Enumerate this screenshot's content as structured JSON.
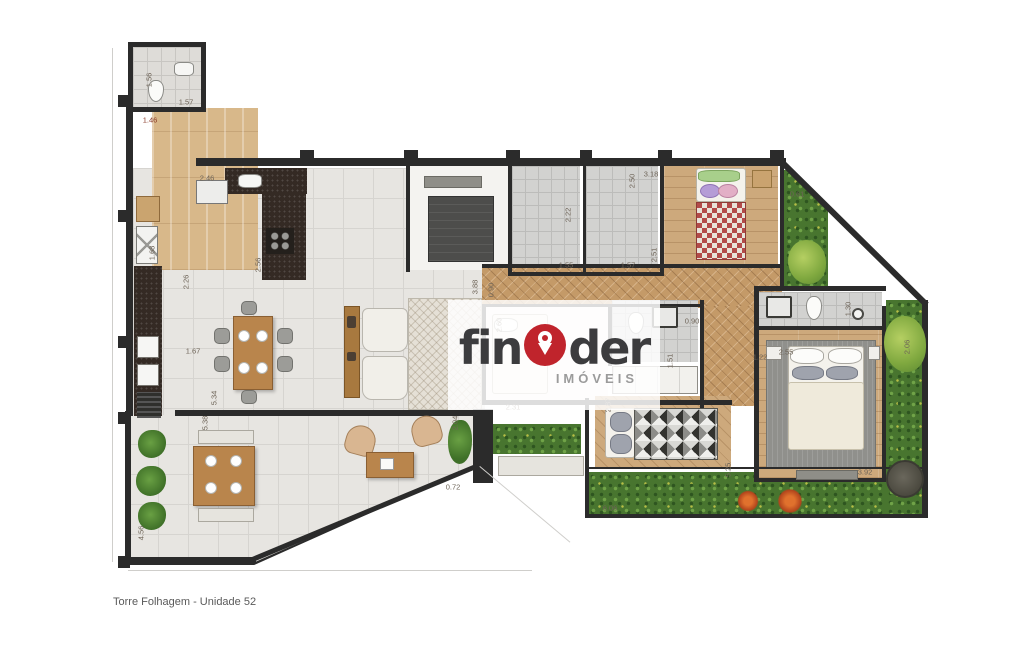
{
  "meta": {
    "caption": "Torre Folhagem - Unidade 52"
  },
  "watermark": {
    "brand_prefix": "fin",
    "brand_suffix": "der",
    "subtitle": "IMÓVEIS",
    "accent": "#c0242c",
    "text_color": "#3c3c3e"
  },
  "plan": {
    "wall_color": "#2b2b2b",
    "rooms": [
      {
        "n": "terrace-outline",
        "c": "wall-poly",
        "x": 125,
        "y": 411,
        "w": 363,
        "h": 154
      },
      {
        "n": "terrace",
        "c": "tile terrace-clip",
        "x": 128,
        "y": 414,
        "w": 357,
        "h": 148
      },
      {
        "n": "kitchen-living-floor",
        "c": "tile",
        "x": 133,
        "y": 168,
        "w": 352,
        "h": 247
      },
      {
        "n": "service-corridor",
        "c": "wood-v",
        "x": 152,
        "y": 108,
        "w": 106,
        "h": 162
      },
      {
        "n": "entry-bath",
        "c": "tile-sm",
        "x": 133,
        "y": 47,
        "w": 68,
        "h": 60
      },
      {
        "n": "central-room",
        "c": "white-room",
        "x": 408,
        "y": 166,
        "w": 100,
        "h": 104
      },
      {
        "n": "bath-1",
        "c": "gray-tile",
        "x": 512,
        "y": 166,
        "w": 68,
        "h": 108
      },
      {
        "n": "bath-2",
        "c": "gray-tile",
        "x": 586,
        "y": 166,
        "w": 72,
        "h": 108
      },
      {
        "n": "bedroom-1",
        "c": "wood-h",
        "x": 664,
        "y": 166,
        "w": 114,
        "h": 110
      },
      {
        "n": "garden-top",
        "c": "garden clip-tr",
        "x": 784,
        "y": 170,
        "w": 44,
        "h": 120
      },
      {
        "n": "hall-herringbone",
        "c": "herringbone",
        "x": 482,
        "y": 268,
        "w": 300,
        "h": 40
      },
      {
        "n": "hall-herringbone-2",
        "c": "herringbone",
        "x": 700,
        "y": 306,
        "w": 54,
        "h": 100
      },
      {
        "n": "garden-bottom",
        "c": "garden",
        "x": 588,
        "y": 472,
        "w": 338,
        "h": 44
      },
      {
        "n": "garden-right",
        "c": "garden",
        "x": 886,
        "y": 300,
        "w": 38,
        "h": 216
      },
      {
        "n": "center-bedroom",
        "c": "white-room",
        "x": 486,
        "y": 306,
        "w": 122,
        "h": 94
      },
      {
        "n": "center-bath",
        "c": "gray-tile",
        "x": 612,
        "y": 300,
        "w": 86,
        "h": 62
      },
      {
        "n": "single-bedroom",
        "c": "wood-diag",
        "x": 595,
        "y": 396,
        "w": 136,
        "h": 72
      },
      {
        "n": "master-bath",
        "c": "gray-tile",
        "x": 758,
        "y": 292,
        "w": 124,
        "h": 36
      },
      {
        "n": "master-bedroom",
        "c": "wood-h",
        "x": 758,
        "y": 330,
        "w": 124,
        "h": 148
      },
      {
        "n": "master-rug",
        "c": "rug-gray",
        "x": 766,
        "y": 340,
        "w": 110,
        "h": 128
      },
      {
        "n": "living-rug",
        "c": "rug-hatch",
        "x": 408,
        "y": 298,
        "w": 74,
        "h": 112
      },
      {
        "n": "laundry-counter",
        "c": "dark-counter",
        "x": 134,
        "y": 266,
        "w": 28,
        "h": 150
      },
      {
        "n": "kitchen-counter-top",
        "c": "dark-counter",
        "x": 225,
        "y": 168,
        "w": 82,
        "h": 26
      },
      {
        "n": "kitchen-counter-side",
        "c": "dark-counter",
        "x": 262,
        "y": 194,
        "w": 44,
        "h": 86
      },
      {
        "n": "planter-strip",
        "c": "garden",
        "x": 493,
        "y": 424,
        "w": 88,
        "h": 30
      }
    ],
    "walls": [
      {
        "x": 126,
        "y": 96,
        "w": 7,
        "h": 320
      },
      {
        "x": 126,
        "y": 414,
        "w": 5,
        "h": 148
      },
      {
        "x": 128,
        "y": 557,
        "w": 128,
        "h": 5
      },
      {
        "x": 252,
        "y": 557,
        "w": 248,
        "h": 5,
        "r": -22.6
      },
      {
        "x": 175,
        "y": 410,
        "w": 312,
        "h": 6
      },
      {
        "x": 196,
        "y": 158,
        "w": 590,
        "h": 8
      },
      {
        "x": 128,
        "y": 42,
        "w": 78,
        "h": 5
      },
      {
        "x": 128,
        "y": 42,
        "w": 5,
        "h": 70
      },
      {
        "x": 201,
        "y": 42,
        "w": 5,
        "h": 70
      },
      {
        "x": 128,
        "y": 107,
        "w": 78,
        "h": 5
      },
      {
        "x": 406,
        "y": 162,
        "w": 4,
        "h": 110
      },
      {
        "x": 508,
        "y": 162,
        "w": 4,
        "h": 114
      },
      {
        "x": 583,
        "y": 162,
        "w": 3,
        "h": 114
      },
      {
        "x": 660,
        "y": 162,
        "w": 4,
        "h": 114
      },
      {
        "x": 780,
        "y": 162,
        "w": 4,
        "h": 128
      },
      {
        "x": 510,
        "y": 272,
        "w": 152,
        "h": 4
      },
      {
        "x": 482,
        "y": 264,
        "w": 302,
        "h": 4
      },
      {
        "x": 482,
        "y": 304,
        "w": 222,
        "h": 3
      },
      {
        "x": 482,
        "y": 304,
        "w": 4,
        "h": 100
      },
      {
        "x": 482,
        "y": 400,
        "w": 250,
        "h": 5
      },
      {
        "x": 608,
        "y": 306,
        "w": 4,
        "h": 60
      },
      {
        "x": 700,
        "y": 300,
        "w": 4,
        "h": 108
      },
      {
        "x": 754,
        "y": 286,
        "w": 132,
        "h": 5
      },
      {
        "x": 754,
        "y": 286,
        "w": 5,
        "h": 194
      },
      {
        "x": 756,
        "y": 326,
        "w": 128,
        "h": 4
      },
      {
        "x": 882,
        "y": 306,
        "w": 4,
        "h": 174
      },
      {
        "x": 922,
        "y": 300,
        "w": 6,
        "h": 218
      },
      {
        "x": 782,
        "y": 158,
        "w": 206,
        "h": 6,
        "r": 44.6
      },
      {
        "x": 585,
        "y": 514,
        "w": 343,
        "h": 4
      },
      {
        "x": 585,
        "y": 398,
        "w": 4,
        "h": 118
      },
      {
        "x": 588,
        "y": 467,
        "w": 340,
        "h": 2
      },
      {
        "x": 754,
        "y": 478,
        "w": 132,
        "h": 4
      },
      {
        "x": 473,
        "y": 409,
        "w": 20,
        "h": 74
      },
      {
        "x": 300,
        "y": 150,
        "w": 14,
        "h": 10
      },
      {
        "x": 404,
        "y": 150,
        "w": 14,
        "h": 10
      },
      {
        "x": 506,
        "y": 150,
        "w": 14,
        "h": 10
      },
      {
        "x": 580,
        "y": 150,
        "w": 12,
        "h": 10
      },
      {
        "x": 658,
        "y": 150,
        "w": 14,
        "h": 10
      },
      {
        "x": 770,
        "y": 150,
        "w": 14,
        "h": 10
      },
      {
        "x": 118,
        "y": 95,
        "w": 12,
        "h": 12
      },
      {
        "x": 118,
        "y": 210,
        "w": 12,
        "h": 12
      },
      {
        "x": 118,
        "y": 336,
        "w": 12,
        "h": 12
      },
      {
        "x": 118,
        "y": 412,
        "w": 12,
        "h": 12
      },
      {
        "x": 118,
        "y": 556,
        "w": 12,
        "h": 12
      },
      {
        "x": 112,
        "y": 48,
        "w": 1,
        "h": 514,
        "bg": "#cfcecb"
      },
      {
        "x": 128,
        "y": 570,
        "w": 404,
        "h": 1,
        "bg": "#cfcecb"
      },
      {
        "x": 480,
        "y": 466,
        "w": 118,
        "h": 1,
        "r": 40,
        "bg": "#cfcecb"
      }
    ],
    "furniture": [
      {
        "k": "toilet",
        "x": 148,
        "y": 80,
        "w": 16,
        "h": 22
      },
      {
        "k": "sink",
        "x": 174,
        "y": 62,
        "w": 20,
        "h": 14
      },
      {
        "k": "cab",
        "x": 196,
        "y": 180,
        "w": 32,
        "h": 24
      },
      {
        "k": "sink",
        "x": 238,
        "y": 174,
        "w": 24,
        "h": 14
      },
      {
        "k": "cooktop",
        "x": 266,
        "y": 228,
        "w": 28,
        "h": 26
      },
      {
        "k": "cab-wood",
        "x": 136,
        "y": 196,
        "w": 24,
        "h": 26
      },
      {
        "k": "xcab",
        "x": 136,
        "y": 226,
        "w": 22,
        "h": 38
      },
      {
        "k": "washer",
        "x": 137,
        "y": 336,
        "w": 22,
        "h": 22
      },
      {
        "k": "washer",
        "x": 137,
        "y": 364,
        "w": 22,
        "h": 22
      },
      {
        "k": "grill",
        "x": 137,
        "y": 392,
        "w": 24,
        "h": 26
      },
      {
        "k": "bench-dark",
        "x": 424,
        "y": 176,
        "w": 58,
        "h": 12
      },
      {
        "k": "dark-box",
        "x": 428,
        "y": 196,
        "w": 66,
        "h": 66
      },
      {
        "k": "table-wood",
        "x": 233,
        "y": 316,
        "w": 40,
        "h": 74
      },
      {
        "k": "chair",
        "x": 214,
        "y": 328,
        "w": 16,
        "h": 16
      },
      {
        "k": "chair",
        "x": 214,
        "y": 356,
        "w": 16,
        "h": 16
      },
      {
        "k": "chair",
        "x": 277,
        "y": 328,
        "w": 16,
        "h": 16
      },
      {
        "k": "chair",
        "x": 277,
        "y": 356,
        "w": 16,
        "h": 16
      },
      {
        "k": "chair",
        "x": 241,
        "y": 301,
        "w": 16,
        "h": 14
      },
      {
        "k": "chair",
        "x": 241,
        "y": 390,
        "w": 16,
        "h": 14
      },
      {
        "k": "plate",
        "x": 238,
        "y": 330,
        "w": 12,
        "h": 12
      },
      {
        "k": "plate",
        "x": 256,
        "y": 330,
        "w": 12,
        "h": 12
      },
      {
        "k": "plate",
        "x": 238,
        "y": 362,
        "w": 12,
        "h": 12
      },
      {
        "k": "plate",
        "x": 256,
        "y": 362,
        "w": 12,
        "h": 12
      },
      {
        "k": "console",
        "x": 344,
        "y": 306,
        "w": 16,
        "h": 92
      },
      {
        "k": "deco",
        "x": 347,
        "y": 316,
        "w": 9,
        "h": 12
      },
      {
        "k": "deco",
        "x": 347,
        "y": 352,
        "w": 9,
        "h": 9
      },
      {
        "k": "sofa",
        "x": 362,
        "y": 308,
        "w": 46,
        "h": 44
      },
      {
        "k": "sofa",
        "x": 362,
        "y": 356,
        "w": 46,
        "h": 44
      },
      {
        "k": "armchair",
        "x": 350,
        "y": 422,
        "w": 30,
        "h": 30,
        "r": 15
      },
      {
        "k": "armchair",
        "x": 408,
        "y": 420,
        "w": 30,
        "h": 30,
        "r": -15
      },
      {
        "k": "table-wood",
        "x": 366,
        "y": 452,
        "w": 48,
        "h": 26
      },
      {
        "k": "deco-white",
        "x": 380,
        "y": 458,
        "w": 14,
        "h": 12
      },
      {
        "k": "plant",
        "x": 448,
        "y": 420,
        "w": 24,
        "h": 44
      },
      {
        "k": "bench",
        "x": 198,
        "y": 430,
        "w": 56,
        "h": 14
      },
      {
        "k": "table-wood",
        "x": 193,
        "y": 446,
        "w": 62,
        "h": 60
      },
      {
        "k": "bench",
        "x": 198,
        "y": 508,
        "w": 56,
        "h": 14
      },
      {
        "k": "plate",
        "x": 205,
        "y": 455,
        "w": 12,
        "h": 12
      },
      {
        "k": "plate",
        "x": 230,
        "y": 455,
        "w": 12,
        "h": 12
      },
      {
        "k": "plate",
        "x": 205,
        "y": 482,
        "w": 12,
        "h": 12
      },
      {
        "k": "plate",
        "x": 230,
        "y": 482,
        "w": 12,
        "h": 12
      },
      {
        "k": "plant",
        "x": 138,
        "y": 430,
        "w": 28,
        "h": 28
      },
      {
        "k": "plant",
        "x": 136,
        "y": 466,
        "w": 30,
        "h": 30
      },
      {
        "k": "plant",
        "x": 138,
        "y": 502,
        "w": 28,
        "h": 28
      },
      {
        "k": "sheet",
        "x": 696,
        "y": 168,
        "w": 50,
        "h": 34
      },
      {
        "k": "pillow-green",
        "x": 698,
        "y": 170,
        "w": 42,
        "h": 12
      },
      {
        "k": "pillow-purple",
        "x": 700,
        "y": 184,
        "w": 20,
        "h": 14
      },
      {
        "k": "pillow-pink",
        "x": 718,
        "y": 184,
        "w": 20,
        "h": 14
      },
      {
        "k": "blanket-red",
        "x": 696,
        "y": 202,
        "w": 50,
        "h": 58
      },
      {
        "k": "side-table",
        "x": 752,
        "y": 170,
        "w": 20,
        "h": 18
      },
      {
        "k": "sheet",
        "x": 492,
        "y": 314,
        "w": 56,
        "h": 80
      },
      {
        "k": "pillow",
        "x": 494,
        "y": 318,
        "w": 24,
        "h": 14
      },
      {
        "k": "toilet",
        "x": 628,
        "y": 312,
        "w": 16,
        "h": 22
      },
      {
        "k": "sink-dark",
        "x": 652,
        "y": 306,
        "w": 26,
        "h": 22
      },
      {
        "k": "wardrobe",
        "x": 612,
        "y": 366,
        "w": 86,
        "h": 28
      },
      {
        "k": "bench",
        "x": 498,
        "y": 456,
        "w": 86,
        "h": 20
      },
      {
        "k": "sink-dark",
        "x": 766,
        "y": 296,
        "w": 26,
        "h": 22
      },
      {
        "k": "toilet",
        "x": 806,
        "y": 296,
        "w": 16,
        "h": 24
      },
      {
        "k": "lamp",
        "x": 852,
        "y": 308,
        "w": 12,
        "h": 12
      },
      {
        "k": "sheet",
        "x": 788,
        "y": 346,
        "w": 76,
        "h": 40
      },
      {
        "k": "pillow",
        "x": 790,
        "y": 348,
        "w": 34,
        "h": 16
      },
      {
        "k": "pillow",
        "x": 828,
        "y": 348,
        "w": 34,
        "h": 16
      },
      {
        "k": "pillow-gray",
        "x": 792,
        "y": 366,
        "w": 32,
        "h": 14
      },
      {
        "k": "pillow-gray",
        "x": 826,
        "y": 366,
        "w": 32,
        "h": 14
      },
      {
        "k": "duvet",
        "x": 788,
        "y": 382,
        "w": 76,
        "h": 68
      },
      {
        "k": "bench-dark",
        "x": 796,
        "y": 470,
        "w": 62,
        "h": 10
      },
      {
        "k": "nightstand",
        "x": 766,
        "y": 346,
        "w": 16,
        "h": 14
      },
      {
        "k": "nightstand",
        "x": 868,
        "y": 346,
        "w": 12,
        "h": 14
      },
      {
        "k": "sheet",
        "x": 605,
        "y": 408,
        "w": 30,
        "h": 50
      },
      {
        "k": "pillow-gray",
        "x": 610,
        "y": 412,
        "w": 22,
        "h": 20
      },
      {
        "k": "pillow-gray",
        "x": 610,
        "y": 434,
        "w": 22,
        "h": 20
      },
      {
        "k": "blanket-tri",
        "x": 634,
        "y": 408,
        "w": 84,
        "h": 52
      },
      {
        "k": "dark-circle",
        "x": 886,
        "y": 460,
        "w": 38,
        "h": 38
      },
      {
        "k": "bush",
        "x": 788,
        "y": 240,
        "w": 38,
        "h": 44
      },
      {
        "k": "bush",
        "x": 884,
        "y": 316,
        "w": 42,
        "h": 56
      },
      {
        "k": "flower",
        "x": 735,
        "y": 490,
        "w": 26,
        "h": 22
      },
      {
        "k": "flower",
        "x": 775,
        "y": 488,
        "w": 30,
        "h": 26
      }
    ],
    "labels": [
      {
        "t": "1.56",
        "x": 149,
        "y": 80,
        "r": -90
      },
      {
        "t": "1.57",
        "x": 186,
        "y": 102
      },
      {
        "t": "1.46",
        "x": 150,
        "y": 120,
        "bg2": "none",
        "col": "#8a3a28"
      },
      {
        "t": "2.46",
        "x": 207,
        "y": 178
      },
      {
        "t": "2.56",
        "x": 258,
        "y": 265,
        "r": -90
      },
      {
        "t": "1.68",
        "x": 152,
        "y": 253,
        "r": -90
      },
      {
        "t": "2.26",
        "x": 186,
        "y": 282,
        "r": -90
      },
      {
        "t": "1.67",
        "x": 193,
        "y": 351
      },
      {
        "t": "5.34",
        "x": 214,
        "y": 398,
        "r": -90
      },
      {
        "t": "5.38",
        "x": 205,
        "y": 423,
        "r": -90
      },
      {
        "t": "4.56",
        "x": 141,
        "y": 533,
        "r": -90
      },
      {
        "t": "2.22",
        "x": 568,
        "y": 215,
        "r": -90
      },
      {
        "t": "1.55",
        "x": 566,
        "y": 265
      },
      {
        "t": "2.50",
        "x": 632,
        "y": 181,
        "r": -90
      },
      {
        "t": "1.57",
        "x": 628,
        "y": 265
      },
      {
        "t": "2.51",
        "x": 654,
        "y": 255,
        "r": -90
      },
      {
        "t": "3.18",
        "x": 651,
        "y": 174
      },
      {
        "t": "0.61",
        "x": 797,
        "y": 194
      },
      {
        "t": "3.88",
        "x": 475,
        "y": 287,
        "r": -90
      },
      {
        "t": "0.90",
        "x": 491,
        "y": 290,
        "r": -90
      },
      {
        "t": "2.60",
        "x": 499,
        "y": 325,
        "r": -90
      },
      {
        "t": "0.90",
        "x": 692,
        "y": 321
      },
      {
        "t": "1.51",
        "x": 670,
        "y": 361,
        "r": -90
      },
      {
        "t": "2.31",
        "x": 513,
        "y": 407
      },
      {
        "t": "2.04",
        "x": 455,
        "y": 423,
        "r": -90
      },
      {
        "t": "0.72",
        "x": 453,
        "y": 487
      },
      {
        "t": "2.87",
        "x": 608,
        "y": 405,
        "r": -90
      },
      {
        "t": "5.25",
        "x": 728,
        "y": 470,
        "r": -90
      },
      {
        "t": "6.06",
        "x": 610,
        "y": 508
      },
      {
        "t": "3.92",
        "x": 865,
        "y": 472
      },
      {
        "t": "1.22",
        "x": 760,
        "y": 357
      },
      {
        "t": "2.55",
        "x": 786,
        "y": 352
      },
      {
        "t": "1.30",
        "x": 848,
        "y": 309,
        "r": -90
      },
      {
        "t": "2.06",
        "x": 907,
        "y": 347,
        "r": -90
      }
    ]
  }
}
